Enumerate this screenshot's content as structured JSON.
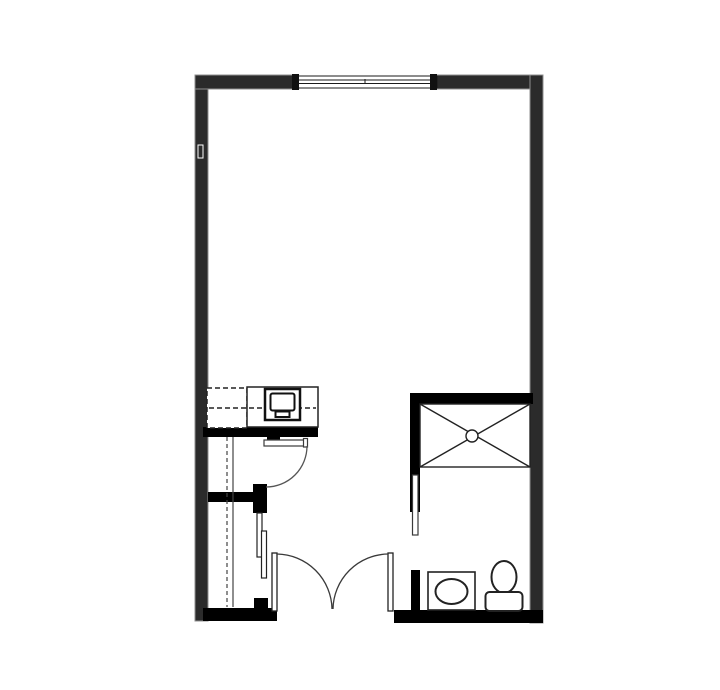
{
  "meta": {
    "title": "studio-apartment-floor-plan",
    "canvas": {
      "width": 720,
      "height": 690
    }
  },
  "colors": {
    "background": "#ffffff",
    "exterior_wall": "#2b2b2b",
    "exterior_wall_edge": "#8f8f8f",
    "interior_wall": "#000000",
    "fixture_line": "#222222",
    "door_line": "#3a3a3a",
    "white": "#ffffff"
  },
  "floorplan": {
    "shapes": [
      {
        "name": "left-wall",
        "type": "rect",
        "x": 195,
        "y": 75,
        "w": 13,
        "h": 546,
        "fill": "#2b2b2b",
        "stroke": "#8f8f8f",
        "sw": 1
      },
      {
        "name": "top-wall-left-segment",
        "type": "rect",
        "x": 195,
        "y": 75,
        "w": 98,
        "h": 14,
        "fill": "#2b2b2b",
        "stroke": "#8f8f8f",
        "sw": 1
      },
      {
        "name": "top-wall-right-segment",
        "type": "rect",
        "x": 437,
        "y": 75,
        "w": 106,
        "h": 14,
        "fill": "#2b2b2b",
        "stroke": "#8f8f8f",
        "sw": 1
      },
      {
        "name": "right-wall",
        "type": "rect",
        "x": 530,
        "y": 75,
        "w": 13,
        "h": 548,
        "fill": "#2b2b2b",
        "stroke": "#8f8f8f",
        "sw": 1
      },
      {
        "name": "window-frame",
        "type": "rect",
        "x": 293,
        "y": 76,
        "w": 144,
        "h": 12,
        "fill": "#ffffff",
        "stroke": "#1a1a1a",
        "sw": 1
      },
      {
        "name": "window-glazing-line-top",
        "type": "line",
        "x1": 293,
        "y1": 80,
        "x2": 437,
        "y2": 80,
        "stroke": "#1a1a1a",
        "sw": 1
      },
      {
        "name": "window-glazing-line-bottom",
        "type": "line",
        "x1": 293,
        "y1": 83.5,
        "x2": 437,
        "y2": 83.5,
        "stroke": "#1a1a1a",
        "sw": 1
      },
      {
        "name": "window-mullion-tick",
        "type": "line",
        "x1": 365,
        "y1": 79,
        "x2": 365,
        "y2": 84,
        "stroke": "#1a1a1a",
        "sw": 1
      },
      {
        "name": "window-jamb-left",
        "type": "rect",
        "x": 292,
        "y": 74,
        "w": 7,
        "h": 16,
        "fill": "#111111"
      },
      {
        "name": "window-jamb-right",
        "type": "rect",
        "x": 430,
        "y": 74,
        "w": 7,
        "h": 16,
        "fill": "#111111"
      },
      {
        "name": "wall-outlet",
        "type": "rect",
        "x": 198,
        "y": 145,
        "w": 5,
        "h": 13,
        "fill": "#2b2b2b",
        "stroke": "#ffffff",
        "sw": 1
      },
      {
        "name": "kitchen-base-wall",
        "type": "rect",
        "x": 203,
        "y": 427,
        "w": 115,
        "h": 10,
        "fill": "#000000"
      },
      {
        "name": "corridor-door-jamb",
        "type": "rect",
        "x": 267,
        "y": 437,
        "w": 13,
        "h": 8,
        "fill": "#000000"
      },
      {
        "name": "closet-mid-wall",
        "type": "rect",
        "x": 208,
        "y": 492,
        "w": 46,
        "h": 10,
        "fill": "#000000"
      },
      {
        "name": "closet-door-jamb-upper",
        "type": "rect",
        "x": 253,
        "y": 484,
        "w": 14,
        "h": 29,
        "fill": "#000000"
      },
      {
        "name": "closet-door-jamb-lower",
        "type": "rect",
        "x": 254,
        "y": 598,
        "w": 14,
        "h": 12,
        "fill": "#000000"
      },
      {
        "name": "bottom-wall-left",
        "type": "rect",
        "x": 203,
        "y": 608,
        "w": 74,
        "h": 13,
        "fill": "#000000"
      },
      {
        "name": "bottom-wall-right",
        "type": "rect",
        "x": 394,
        "y": 610,
        "w": 149,
        "h": 13,
        "fill": "#000000"
      },
      {
        "name": "shower-top-wall",
        "type": "rect",
        "x": 410,
        "y": 393,
        "w": 123,
        "h": 11,
        "fill": "#000000"
      },
      {
        "name": "shower-left-wall",
        "type": "rect",
        "x": 410,
        "y": 393,
        "w": 10,
        "h": 119,
        "fill": "#000000"
      },
      {
        "name": "bathroom-door-jamb-lower",
        "type": "rect",
        "x": 411,
        "y": 570,
        "w": 9,
        "h": 42,
        "fill": "#000000"
      },
      {
        "name": "refrigerator-dashed-outline",
        "type": "rect",
        "x": 207,
        "y": 388,
        "w": 40,
        "h": 40,
        "fill": "#ffffff",
        "stroke": "#222222",
        "sw": 1.5,
        "dash": "5,3"
      },
      {
        "name": "kitchen-counter",
        "type": "rect",
        "x": 247,
        "y": 387,
        "w": 71,
        "h": 40,
        "fill": "#ffffff",
        "stroke": "#222222",
        "sw": 1.5
      },
      {
        "name": "upper-cabinet-depth-line",
        "type": "line",
        "x1": 209,
        "y1": 408,
        "x2": 316,
        "y2": 408,
        "stroke": "#222222",
        "sw": 1.5,
        "dash": "5,3"
      },
      {
        "name": "microwave-outer",
        "type": "rect",
        "x": 265,
        "y": 389,
        "w": 35,
        "h": 31,
        "fill": "#ffffff",
        "stroke": "#111111",
        "sw": 2.5
      },
      {
        "name": "microwave-door",
        "type": "rect",
        "x": 270.5,
        "y": 393.5,
        "w": 24,
        "h": 17,
        "rx": 2,
        "fill": "#ffffff",
        "stroke": "#111111",
        "sw": 2
      },
      {
        "name": "microwave-handle",
        "type": "rect",
        "x": 275.5,
        "y": 411.5,
        "w": 14,
        "h": 5.5,
        "fill": "#ffffff",
        "stroke": "#111111",
        "sw": 2
      },
      {
        "name": "corridor-door-leaf",
        "type": "rect",
        "x": 264,
        "y": 440,
        "w": 40,
        "h": 6,
        "fill": "#ffffff",
        "stroke": "#3a3a3a",
        "sw": 1.2
      },
      {
        "name": "corridor-door-leaf-cap",
        "type": "rect",
        "x": 303.5,
        "y": 438.5,
        "w": 4,
        "h": 8.5,
        "fill": "#ffffff",
        "stroke": "#3a3a3a",
        "sw": 1.2
      },
      {
        "name": "corridor-door-swing-arc",
        "type": "path",
        "d": "M 307 446 A 41 41 0 0 1 266 487",
        "fill": "none",
        "stroke": "#555555",
        "sw": 1.3
      },
      {
        "name": "closet-rod-dashed-line",
        "type": "line",
        "x1": 227,
        "y1": 437,
        "x2": 227,
        "y2": 607,
        "stroke": "#444444",
        "sw": 1.2,
        "dash": "4,3"
      },
      {
        "name": "closet-shelf-line",
        "type": "line",
        "x1": 233,
        "y1": 437,
        "x2": 233,
        "y2": 607,
        "stroke": "#444444",
        "sw": 1.2
      },
      {
        "name": "closet-sliding-panel-front",
        "type": "rect",
        "x": 257,
        "y": 513,
        "w": 5,
        "h": 44,
        "fill": "#ffffff",
        "stroke": "#222222",
        "sw": 1.2
      },
      {
        "name": "closet-sliding-panel-back",
        "type": "rect",
        "x": 261.5,
        "y": 531,
        "w": 5,
        "h": 47,
        "fill": "#ffffff",
        "stroke": "#222222",
        "sw": 1.2
      },
      {
        "name": "french-door-left-leaf",
        "type": "rect",
        "x": 272,
        "y": 553,
        "w": 5,
        "h": 58,
        "fill": "#ffffff",
        "stroke": "#222222",
        "sw": 1.3
      },
      {
        "name": "french-door-right-leaf",
        "type": "rect",
        "x": 388,
        "y": 553,
        "w": 5,
        "h": 58,
        "fill": "#ffffff",
        "stroke": "#222222",
        "sw": 1.3
      },
      {
        "name": "french-door-left-swing-arc",
        "type": "path",
        "d": "M 277 554 A 56 56 0 0 1 332 609",
        "fill": "none",
        "stroke": "#3a3a3a",
        "sw": 1.3
      },
      {
        "name": "french-door-right-swing-arc",
        "type": "path",
        "d": "M 388 554 A 56 56 0 0 0 333 609",
        "fill": "none",
        "stroke": "#3a3a3a",
        "sw": 1.3
      },
      {
        "name": "shower-pan",
        "type": "rect",
        "x": 420,
        "y": 404,
        "w": 110,
        "h": 63,
        "fill": "#ffffff",
        "stroke": "#222222",
        "sw": 1.4
      },
      {
        "name": "shower-pan-diagonal-1",
        "type": "line",
        "x1": 420,
        "y1": 404,
        "x2": 530,
        "y2": 467,
        "stroke": "#222222",
        "sw": 1.4
      },
      {
        "name": "shower-pan-diagonal-2",
        "type": "line",
        "x1": 530,
        "y1": 404,
        "x2": 420,
        "y2": 467,
        "stroke": "#222222",
        "sw": 1.4
      },
      {
        "name": "shower-drain",
        "type": "circle",
        "cx": 472,
        "cy": 436,
        "r": 6,
        "fill": "#ffffff",
        "stroke": "#222222",
        "sw": 1.4
      },
      {
        "name": "bathroom-sliding-door-panel",
        "type": "rect",
        "x": 412.5,
        "y": 475,
        "w": 5.5,
        "h": 60,
        "fill": "#ffffff",
        "stroke": "#3a3a3a",
        "sw": 1.2
      },
      {
        "name": "vanity-counter",
        "type": "rect",
        "x": 428,
        "y": 572,
        "w": 47,
        "h": 38,
        "fill": "#ffffff",
        "stroke": "#222222",
        "sw": 1.6
      },
      {
        "name": "sink-basin",
        "type": "ellipse",
        "cx": 451.5,
        "cy": 591.5,
        "rx": 16,
        "ry": 12.5,
        "fill": "#ffffff",
        "stroke": "#222222",
        "sw": 2
      },
      {
        "name": "toilet-bowl",
        "type": "ellipse",
        "cx": 504,
        "cy": 577,
        "rx": 12.5,
        "ry": 16,
        "fill": "#ffffff",
        "stroke": "#222222",
        "sw": 2
      },
      {
        "name": "toilet-tank",
        "type": "rect",
        "x": 485.5,
        "y": 592,
        "w": 37,
        "h": 19,
        "rx": 4,
        "fill": "#ffffff",
        "stroke": "#222222",
        "sw": 2
      }
    ]
  }
}
